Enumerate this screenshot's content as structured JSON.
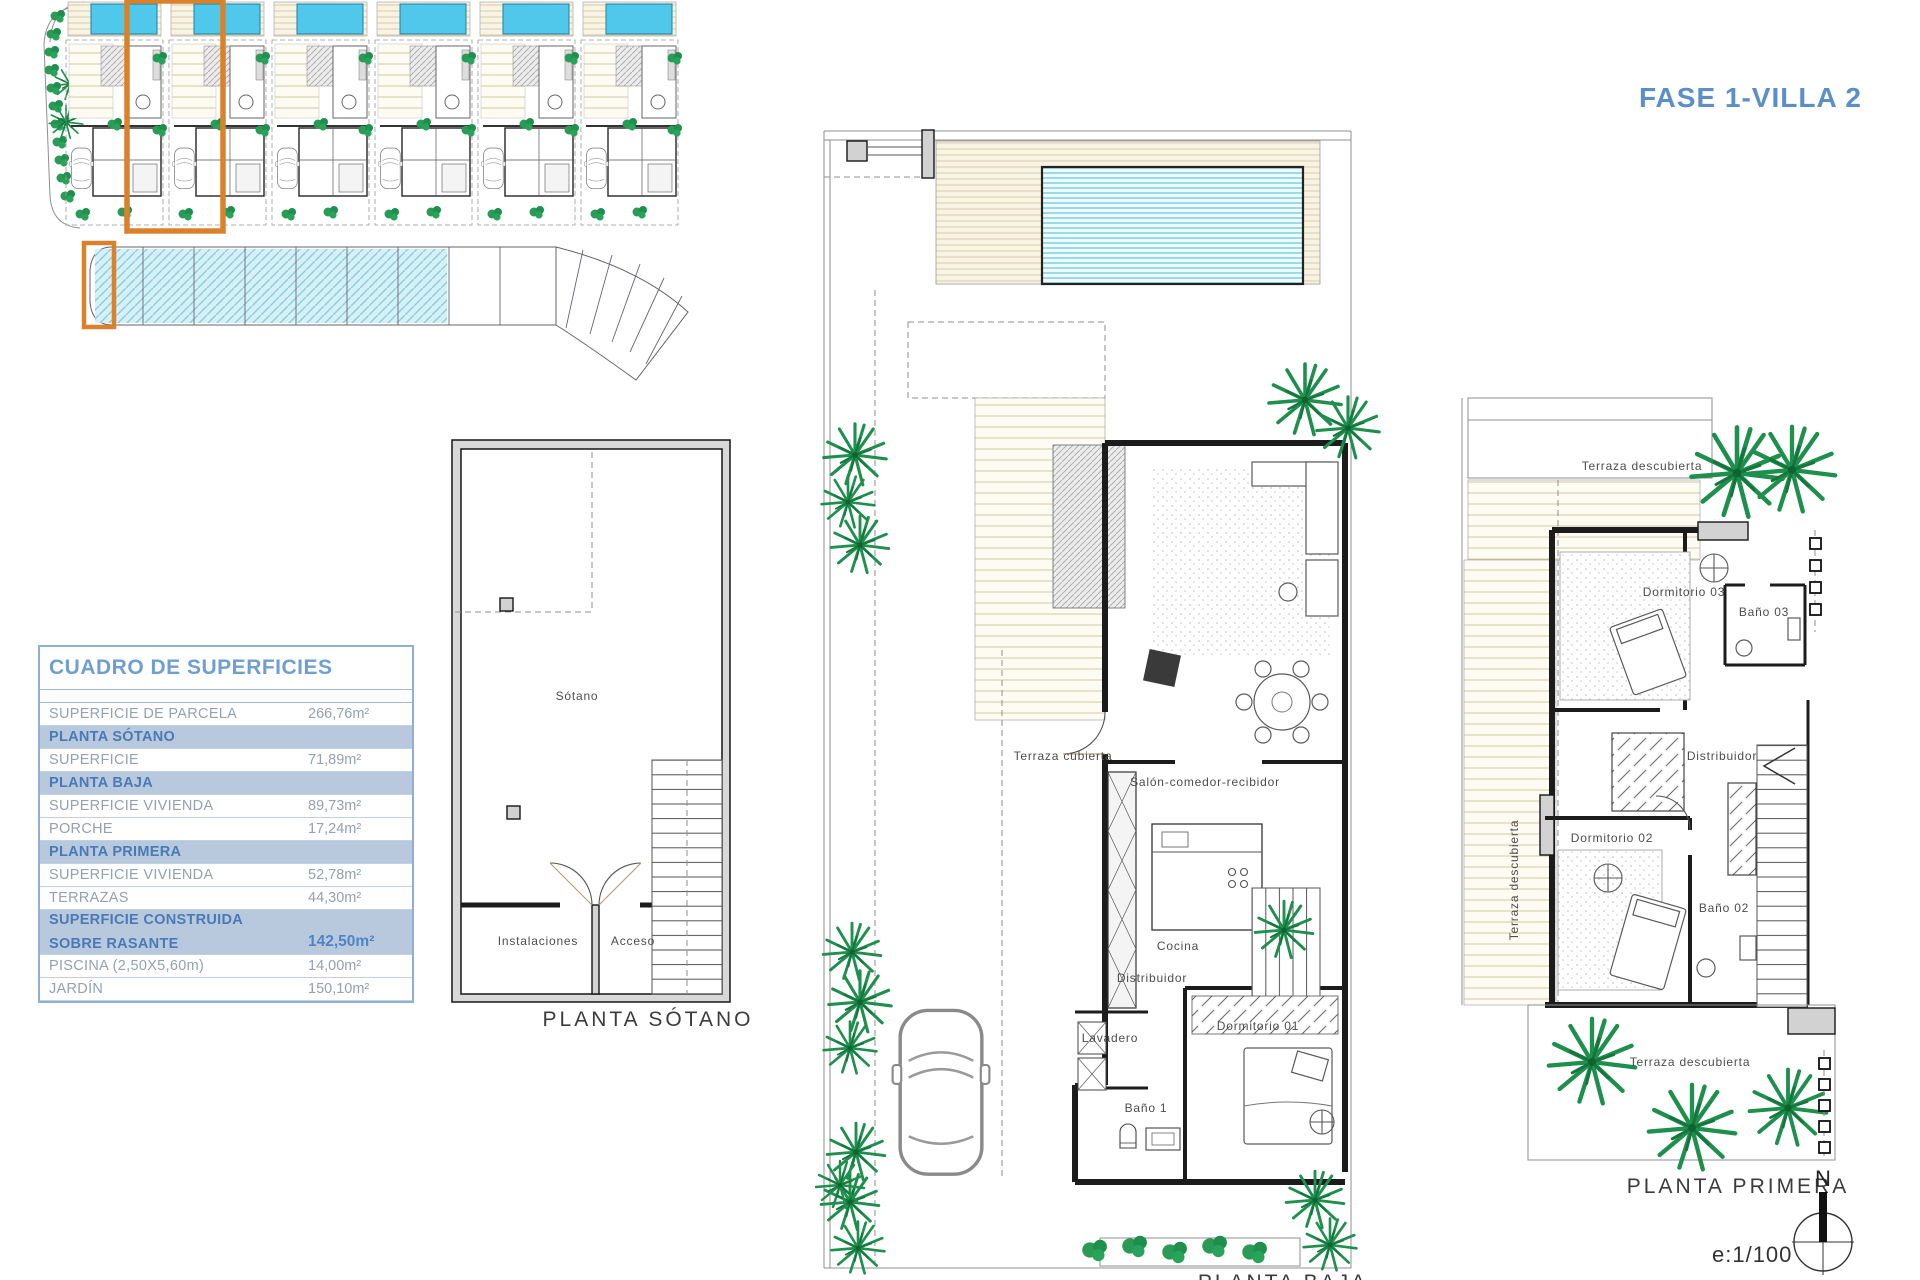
{
  "title": "FASE 1-VILLA 2",
  "colors": {
    "accent_blue": "#5b8fc9",
    "table_section_bg": "#b8c9dd",
    "highlight_orange": "#d9822b",
    "pool_cyan": "#4fc8eb",
    "vegetation_green": "#1e8f4c"
  },
  "table": {
    "title": "CUADRO DE SUPERFICIES",
    "rows": [
      {
        "label": "SUPERFICIE DE PARCELA",
        "value": "266,76m²"
      },
      {
        "label": "PLANTA SÓTANO",
        "value": ""
      },
      {
        "label": "SUPERFICIE",
        "value": "71,89m²"
      },
      {
        "label": "PLANTA BAJA",
        "value": ""
      },
      {
        "label": "SUPERFICIE VIVIENDA",
        "value": "89,73m²"
      },
      {
        "label": "PORCHE",
        "value": "17,24m²"
      },
      {
        "label": "PLANTA PRIMERA",
        "value": ""
      },
      {
        "label": "SUPERFICIE VIVIENDA",
        "value": "52,78m²"
      },
      {
        "label": "TERRAZAS",
        "value": "44,30m²"
      },
      {
        "label_line1": "SUPERFICIE CONSTRUIDA",
        "label_line2": "SOBRE RASANTE",
        "value": "142,50m²"
      },
      {
        "label": "PISCINA (2,50X5,60m)",
        "value": "14,00m²"
      },
      {
        "label": "JARDÍN",
        "value": "150,10m²"
      }
    ]
  },
  "plans": {
    "sotano": {
      "label": "PLANTA SÓTANO",
      "rooms": {
        "sotano": "Sótano",
        "instalaciones": "Instalaciones",
        "acceso": "Acceso"
      }
    },
    "baja": {
      "label": "PLANTA BAJA",
      "rooms": {
        "terraza_cubierta": "Terraza cubierta",
        "salon": "Salón-comedor-recibidor",
        "cocina": "Cocina",
        "distribuidor": "Distribuidor",
        "lavadero": "Lavadero",
        "bano1": "Baño 1",
        "dormitorio01": "Dormitorio 01"
      }
    },
    "primera": {
      "label": "PLANTA PRIMERA",
      "rooms": {
        "terraza_top": "Terraza descubierta",
        "terraza_left": "Terraza descubierta",
        "terraza_bottom": "Terraza descubierta",
        "dormitorio03": "Dormitorio 03",
        "bano03": "Baño 03",
        "distribuidor": "Distribuidor",
        "dormitorio02": "Dormitorio 02",
        "bano02": "Baño 02"
      }
    }
  },
  "footer": {
    "scale": "e:1/100",
    "compass_north": "N"
  }
}
